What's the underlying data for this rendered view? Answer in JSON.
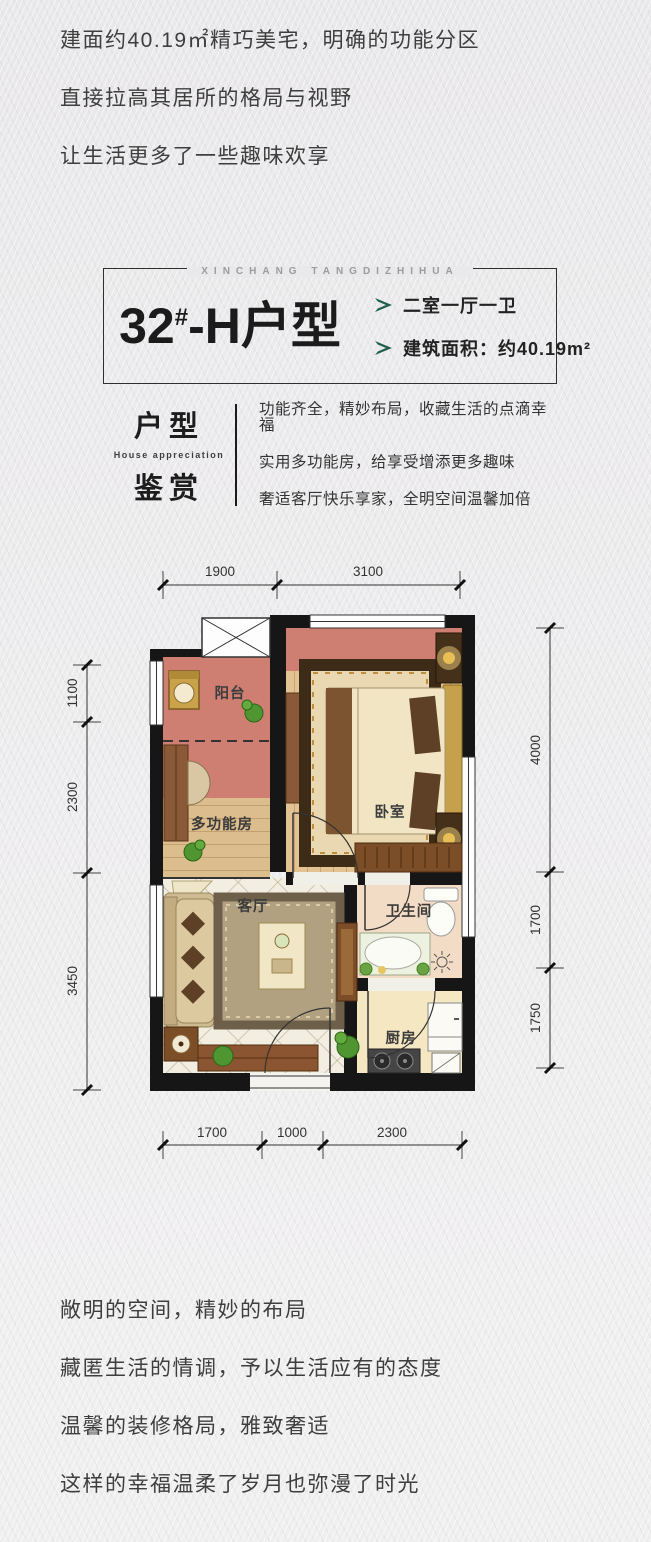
{
  "intro": {
    "lines": [
      "建面约40.19㎡精巧美宅，明确的功能分区",
      "直接拉高其居所的格局与视野",
      "让生活更多了一些趣味欢享"
    ]
  },
  "unit_block": {
    "brand": "XINCHANG TANGDIZHIHUA",
    "number": "32",
    "number_sup": "#",
    "name_suffix": "-H户型",
    "specs": [
      "二室一厅一卫",
      "建筑面积：约40.19m²"
    ],
    "arrow_color": "#20604b"
  },
  "appreciation": {
    "zh_top": "户型",
    "en": "House appreciation",
    "zh_bottom": "鉴赏",
    "lines": [
      "功能齐全，精妙布局，收藏生活的点滴幸福",
      "实用多功能房，给享受增添更多趣味",
      "奢适客厅快乐享家，全明空间温馨加倍"
    ]
  },
  "floorplan": {
    "rooms": {
      "balcony": "阳台",
      "multi": "多功能房",
      "bedroom": "卧室",
      "living": "客厅",
      "bath": "卫生间",
      "kitchen": "厨房"
    },
    "dims": {
      "top": [
        "1900",
        "3100"
      ],
      "bottom": [
        "1700",
        "1000",
        "2300"
      ],
      "left": [
        "1100",
        "2300",
        "3450"
      ],
      "right": [
        "4000",
        "1700",
        "1750"
      ]
    },
    "colors": {
      "wall": "#161616",
      "salmon": "#cf7f72",
      "wood": "#e2c391",
      "wood_multi": "#dcbd8e",
      "tile": "#f2efe2",
      "bath_floor": "#f3dcc6",
      "kitchen_floor": "#f6e7c3"
    }
  },
  "outro": {
    "lines": [
      "敞明的空间，精妙的布局",
      "藏匿生活的情调，予以生活应有的态度",
      "温馨的装修格局，雅致奢适",
      "这样的幸福温柔了岁月也弥漫了时光"
    ]
  }
}
